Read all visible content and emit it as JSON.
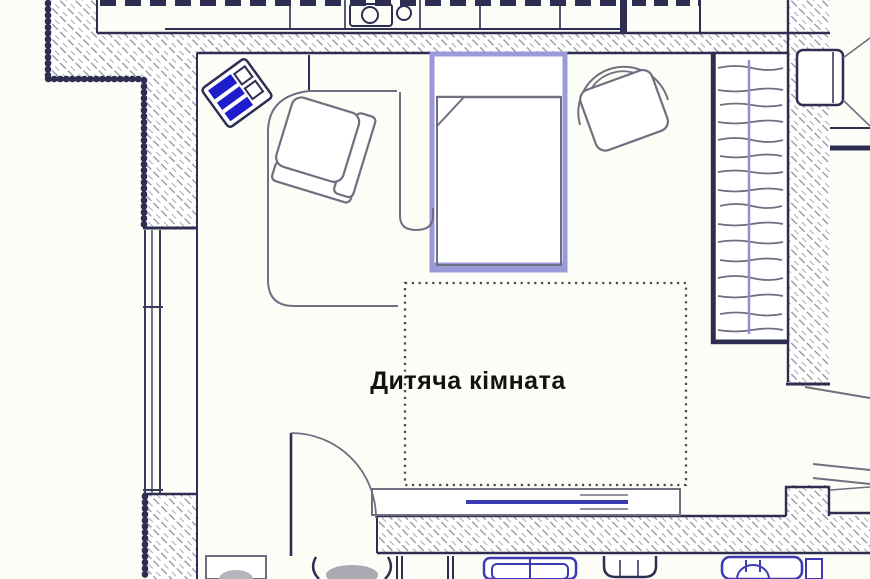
{
  "room": {
    "label": "Дитяча кімната"
  },
  "colors": {
    "bg": "#fdfdf8",
    "wall": "#2e2e52",
    "furn": "#6f6f80",
    "hatch": "#8d8d99",
    "bed": "#9a9ad8",
    "blue": "#1d1dcb",
    "fixture": "#3b3bb4",
    "rail": "#8f8fd0",
    "dot": "#4a4a4a",
    "text": "#121212"
  }
}
